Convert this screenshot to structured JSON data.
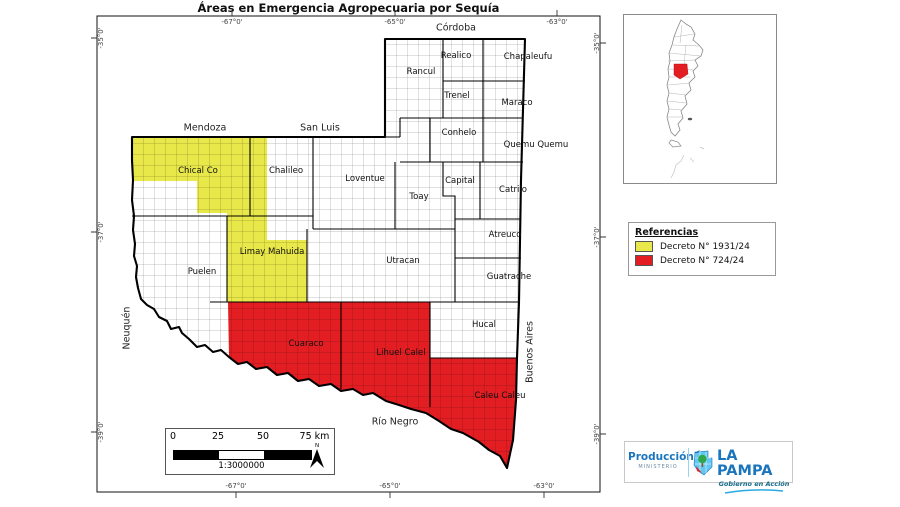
{
  "title": "Áreas en Emergencia Agropecuaria por Sequía",
  "map": {
    "axis": {
      "top": [
        {
          "label": "-67°0'",
          "x": 232
        },
        {
          "label": "-65°0'",
          "x": 395
        },
        {
          "label": "-63°0'",
          "x": 557
        }
      ],
      "bottom": [
        {
          "label": "-67°0'",
          "x": 236
        },
        {
          "label": "-65°0'",
          "x": 390
        },
        {
          "label": "-63°0'",
          "x": 544
        }
      ],
      "left": [
        {
          "label": "-35°0'",
          "y": 38
        },
        {
          "label": "-37°0'",
          "y": 232
        },
        {
          "label": "-39°0'",
          "y": 432
        }
      ],
      "right": [
        {
          "label": "-35°0'",
          "y": 43
        },
        {
          "label": "-37°0'",
          "y": 237
        },
        {
          "label": "-39°0'",
          "y": 434
        }
      ]
    },
    "neighbors": [
      {
        "id": "mendoza",
        "label": "Mendoza",
        "x": 205,
        "y": 128,
        "rot": 0
      },
      {
        "id": "san-luis",
        "label": "San Luis",
        "x": 320,
        "y": 128,
        "rot": 0
      },
      {
        "id": "cordoba",
        "label": "Córdoba",
        "x": 456,
        "y": 28,
        "rot": 0
      },
      {
        "id": "neuquen",
        "label": "Neuquén",
        "x": 127,
        "y": 328,
        "rot": -90
      },
      {
        "id": "rio-negro",
        "label": "Río Negro",
        "x": 395,
        "y": 422,
        "rot": 0
      },
      {
        "id": "buenos-aires",
        "label": "Buenos Aires",
        "x": 530,
        "y": 352,
        "rot": -90
      }
    ],
    "departments": [
      {
        "id": "chical-co",
        "label": "Chical Co",
        "x": 198,
        "y": 171
      },
      {
        "id": "chalileo",
        "label": "Chalileo",
        "x": 286,
        "y": 171
      },
      {
        "id": "loventue",
        "label": "Loventue",
        "x": 365,
        "y": 179
      },
      {
        "id": "toay",
        "label": "Toay",
        "x": 419,
        "y": 197
      },
      {
        "id": "capital",
        "label": "Capital",
        "x": 460,
        "y": 181
      },
      {
        "id": "catrilo",
        "label": "Catrilo",
        "x": 513,
        "y": 190
      },
      {
        "id": "conhelo",
        "label": "Conhelo",
        "x": 459,
        "y": 133
      },
      {
        "id": "rancul",
        "label": "Rancul",
        "x": 421,
        "y": 72
      },
      {
        "id": "realico",
        "label": "Realico",
        "x": 456,
        "y": 56
      },
      {
        "id": "chapaleufu",
        "label": "Chapaleufu",
        "x": 528,
        "y": 57
      },
      {
        "id": "trenel",
        "label": "Trenel",
        "x": 457,
        "y": 96
      },
      {
        "id": "maraco",
        "label": "Maraco",
        "x": 517,
        "y": 103
      },
      {
        "id": "quemu-quemu",
        "label": "Quemu Quemu",
        "x": 536,
        "y": 145
      },
      {
        "id": "atreuco",
        "label": "Atreuco",
        "x": 505,
        "y": 235
      },
      {
        "id": "utracan",
        "label": "Utracan",
        "x": 403,
        "y": 261
      },
      {
        "id": "limay-mahuida",
        "label": "Limay Mahuida",
        "x": 272,
        "y": 252
      },
      {
        "id": "guatrache",
        "label": "Guatrache",
        "x": 509,
        "y": 277
      },
      {
        "id": "puelen",
        "label": "Puelen",
        "x": 202,
        "y": 272
      },
      {
        "id": "hucal",
        "label": "Hucal",
        "x": 484,
        "y": 325
      },
      {
        "id": "cuaraco",
        "label": "Cuaraco",
        "x": 306,
        "y": 344
      },
      {
        "id": "lihuel-calel",
        "label": "Lihuel Calel",
        "x": 401,
        "y": 353
      },
      {
        "id": "caleu-caleu",
        "label": "Caleu Caleu",
        "x": 500,
        "y": 396
      }
    ]
  },
  "legend": {
    "title": "Referencias",
    "items": [
      {
        "label": "Decreto N° 1931/24",
        "color": "#e9e84a"
      },
      {
        "label": "Decreto N° 724/24",
        "color": "#e31e23"
      }
    ]
  },
  "scalebar": {
    "ticks": [
      {
        "label": "0",
        "x": 7
      },
      {
        "label": "25",
        "x": 52
      },
      {
        "label": "50",
        "x": 97
      },
      {
        "label": "75 km",
        "x": 144
      }
    ],
    "ratio": "1:3000000",
    "north_label": "N"
  },
  "inset": {
    "highlight_color": "#e31e23"
  },
  "footer_logo": {
    "ministry": "Producción",
    "ministry_sub": "MINISTERIO",
    "province": "LA PAMPA",
    "tagline": "Gobierno en Acción",
    "brand_blue": "#1b75bc",
    "accent_cyan": "#29abe2"
  }
}
